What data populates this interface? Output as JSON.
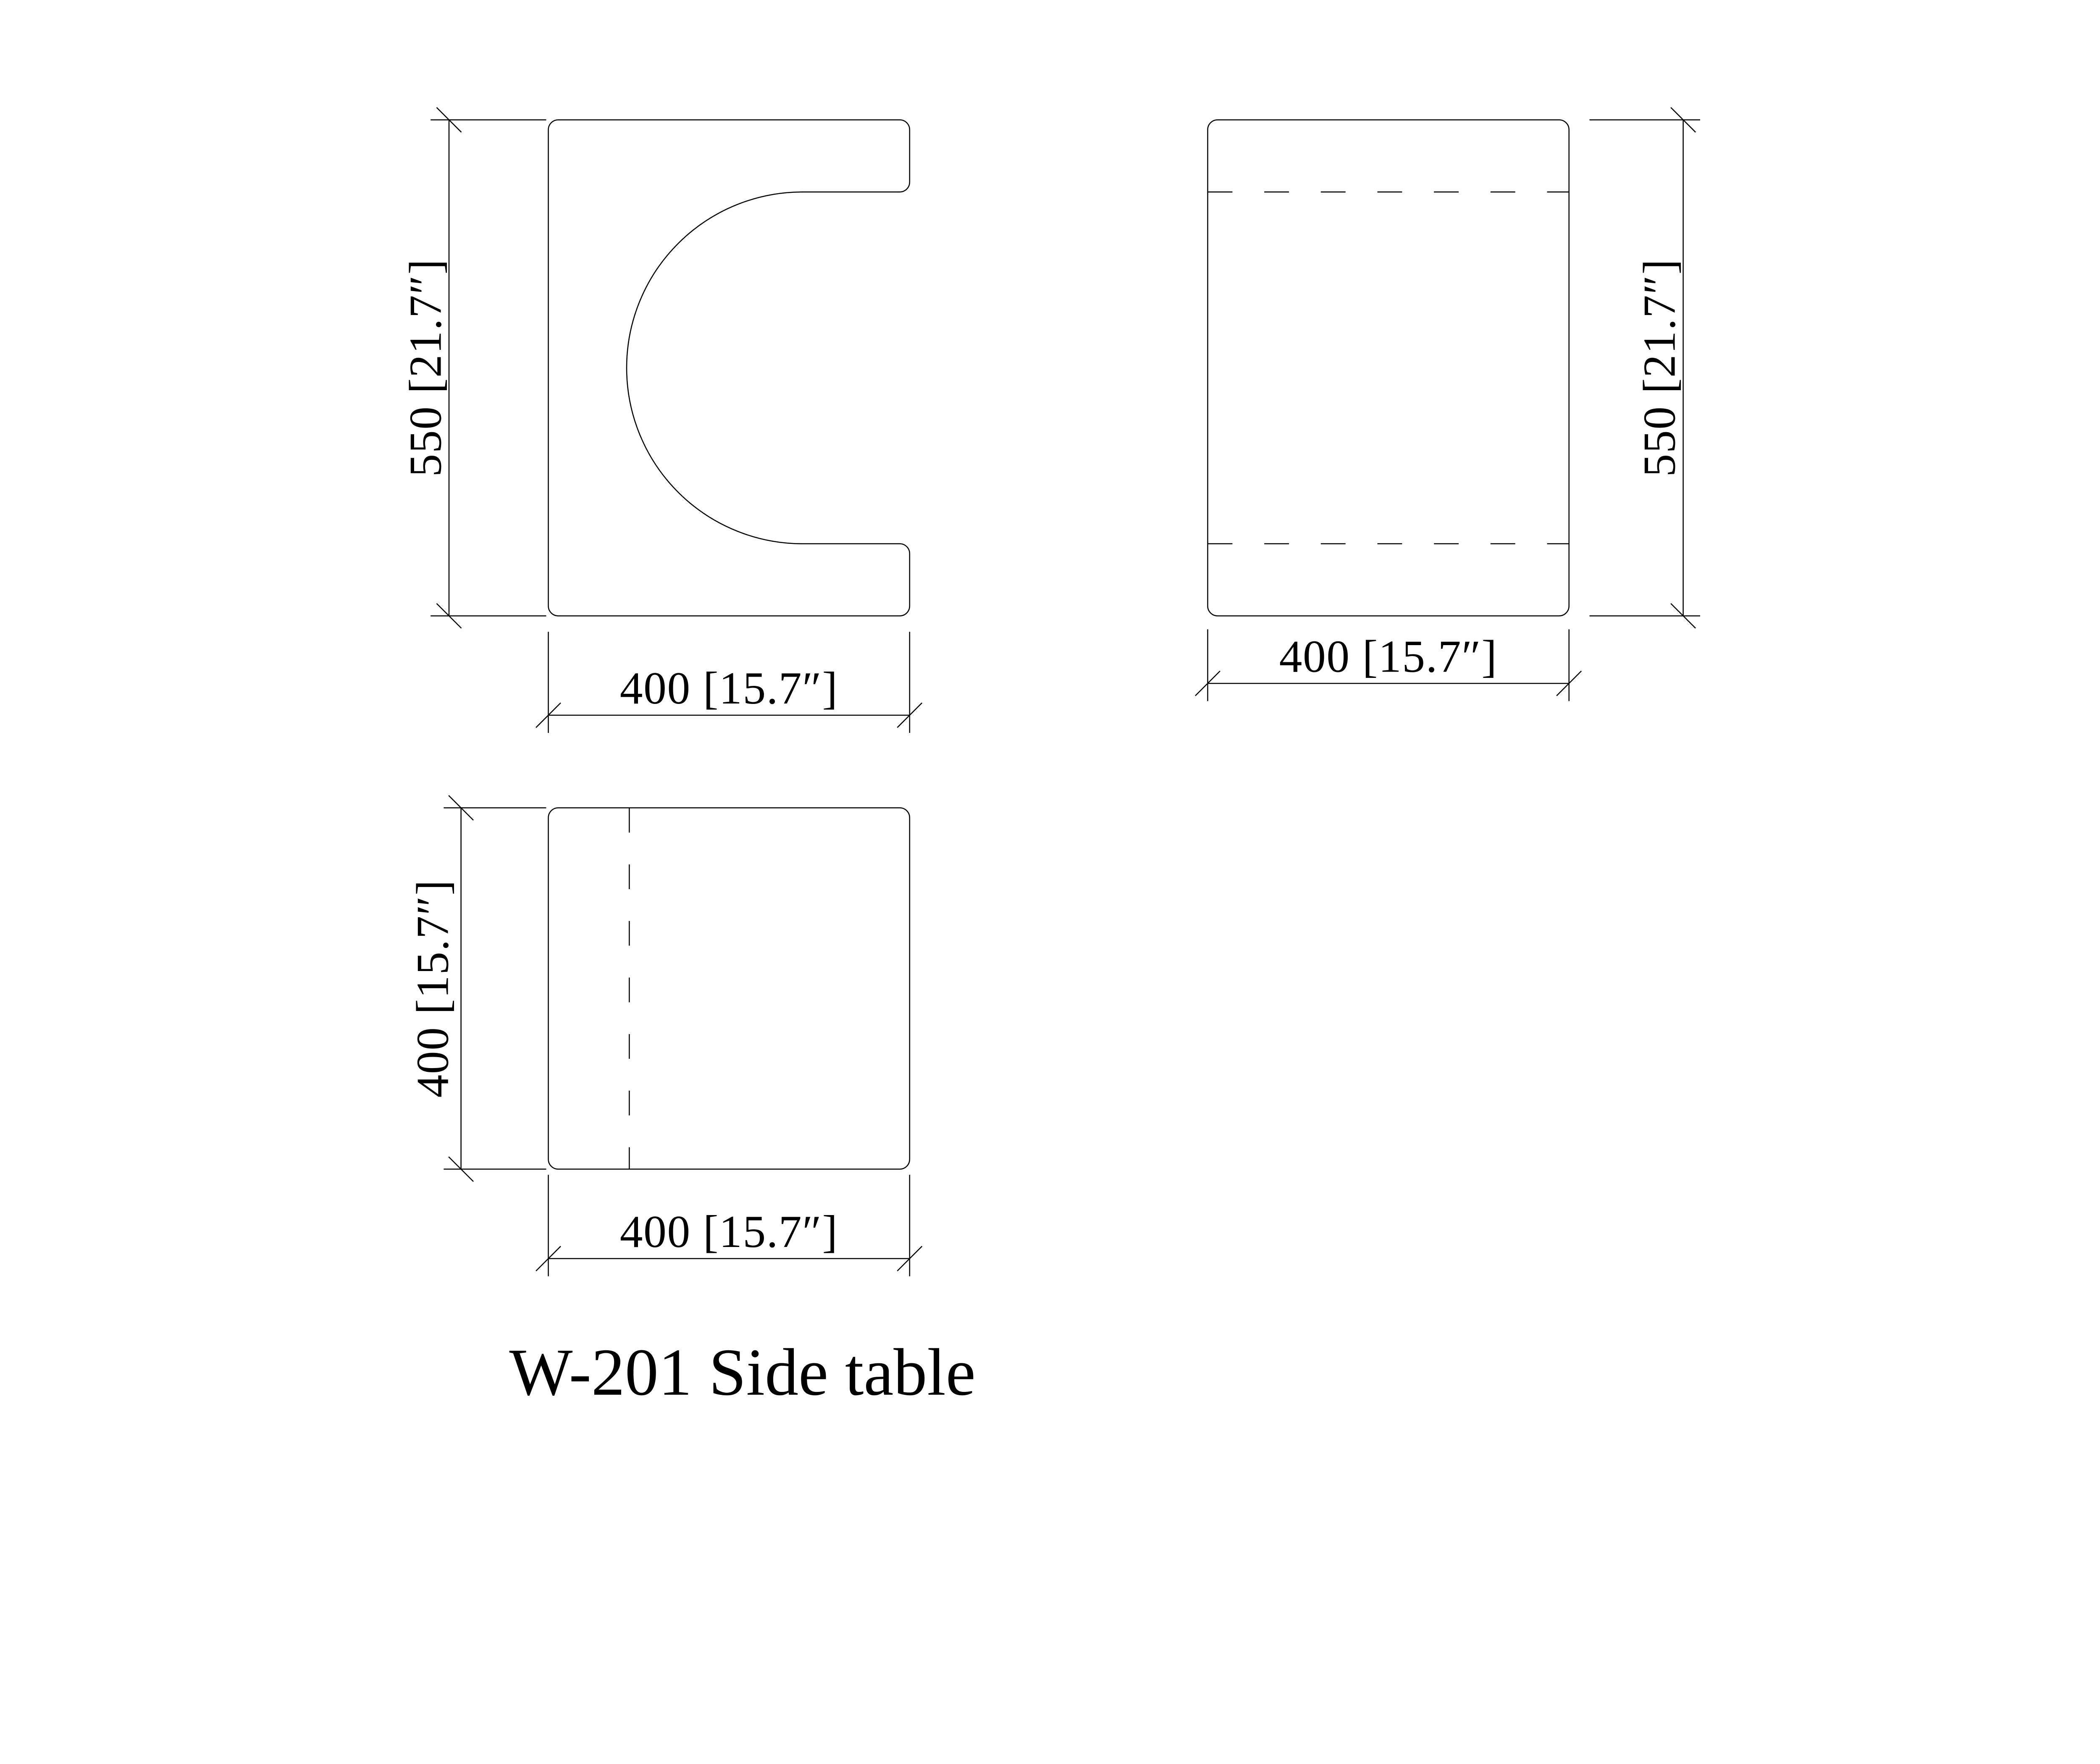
{
  "sheet": {
    "title": "W-201 Side table",
    "background": "#ffffff",
    "line_color": "#000000"
  },
  "views": {
    "front": {
      "height_label": "550 [21.7″]",
      "width_label": "400 [15.7″]"
    },
    "side": {
      "height_label": "550 [21.7″]",
      "width_label": "400 [15.7″]"
    },
    "top": {
      "depth_label": "400 [15.7″]",
      "width_label": "400 [15.7″]"
    }
  }
}
